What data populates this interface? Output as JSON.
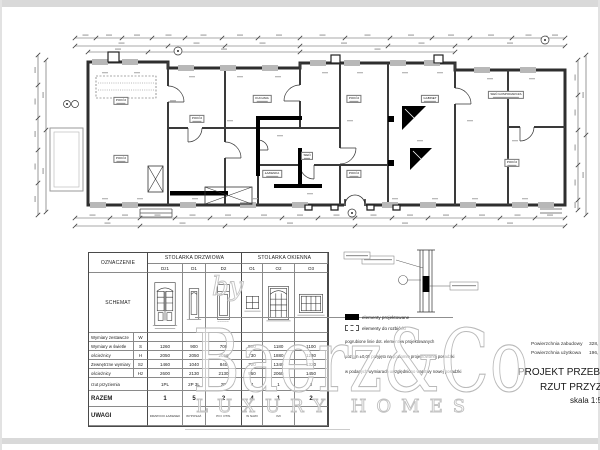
{
  "sheet": {
    "watermark": {
      "main": "Baerz&Co",
      "by": "by",
      "sub": "LUXURY HOMES"
    },
    "info": {
      "area_lines": [
        {
          "label": "Powierzchnia zabudowy",
          "value": "328,"
        },
        {
          "label": "Powierzchnia użytkowa",
          "value": "196,"
        }
      ],
      "title": "PROJEKT PRZEBUDOWY",
      "subtitle": "RZUT PRZYZIEMIA",
      "scale": "skala 1:50"
    },
    "legend": {
      "items": [
        {
          "swatch": "solid",
          "label": "elementy projektowane"
        },
        {
          "swatch": "dashed",
          "label": "elementy do rozbiórki"
        }
      ],
      "notes": [
        "pogrubione linie dot. elementów projektowanych",
        "poziom ±0,00 przyjęto na poziomie projektowanej posadzki",
        "w podanych wymiarach uwzględniono warstwy nowej posadzki"
      ]
    },
    "plan": {
      "rooms": [
        {
          "x": 121,
          "y": 101,
          "name": "POKÓJ"
        },
        {
          "x": 121,
          "y": 159,
          "name": "POKÓJ"
        },
        {
          "x": 197,
          "y": 119,
          "name": "POKÓJ"
        },
        {
          "x": 262,
          "y": 99,
          "name": "KUCHNIA"
        },
        {
          "x": 272,
          "y": 174,
          "name": "ŁAZIENKA"
        },
        {
          "x": 307,
          "y": 156,
          "name": "SIEŃ"
        },
        {
          "x": 354,
          "y": 99,
          "name": "POKÓJ"
        },
        {
          "x": 354,
          "y": 174,
          "name": "POKÓJ"
        },
        {
          "x": 430,
          "y": 99,
          "name": "GABINET"
        },
        {
          "x": 506,
          "y": 95,
          "name": "SIEŃ GOSPODARCZA"
        },
        {
          "x": 512,
          "y": 163,
          "name": "POKÓJ"
        }
      ]
    },
    "schedule": {
      "corner": "OZNACZENIE",
      "group_door": "STOLARKA DRZWIOWA",
      "group_window": "STOLARKA OKIENNA",
      "columns": [
        "Dz1",
        "D1",
        "D2",
        "O1",
        "O2",
        "O3"
      ],
      "schemat_label": "SCHEMAT",
      "dim_rows": [
        {
          "label": "Wymiary zestawcze",
          "sym": "W",
          "values": [
            "",
            "",
            "",
            "",
            "",
            ""
          ]
        },
        {
          "label": "Wymiary w świetle",
          "sym": "S",
          "values": [
            "1260",
            "900",
            "700",
            "500",
            "1180",
            "1100"
          ]
        },
        {
          "label": "ościeżnicy",
          "sym": "H",
          "values": [
            "2050",
            "2050",
            "2050",
            "730",
            "1880",
            "1230"
          ]
        },
        {
          "label": "Zewnętrzne wymiary",
          "sym": "Sz",
          "values": [
            "1460",
            "1040",
            "840",
            "720",
            "1340",
            "1320"
          ]
        },
        {
          "label": "ościeżnicy",
          "sym": "Hz",
          "values": [
            "2600",
            "2130",
            "2130",
            "950",
            "2060",
            "1450"
          ]
        },
        {
          "label": "rzut przyziemia",
          "sym": "",
          "values": [
            "1PL",
            "2P 3L",
            "2P",
            "4",
            "1",
            "2"
          ]
        }
      ],
      "razem": {
        "label": "RAZEM",
        "values": [
          "1",
          "5",
          "2",
          "4",
          "1",
          "2"
        ]
      },
      "uwagi": {
        "label": "UWAGI",
        "values": [
          "DRZWI DO ŁAZIENEK",
          "WYPOSAŻ.",
          "PO I OTW.",
          "W NAWI",
          "IMI",
          ""
        ]
      }
    }
  }
}
